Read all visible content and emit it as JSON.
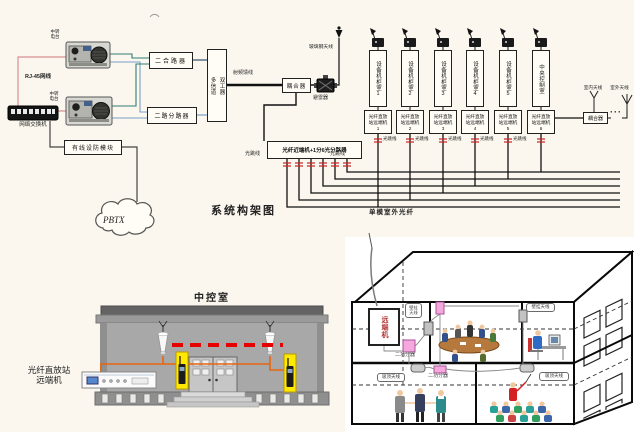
{
  "colors": {
    "page_bg": "#fbf7ee",
    "red_dash": "#e60000",
    "orange_wire": "#e8650f",
    "yellow_holder": "#ffe900",
    "pink_splitter": "#f5a8dc",
    "pink_wire": "#d89090",
    "teal_wire": "#2e7d74",
    "blue_wire": "#7aa0c8",
    "remote_text_red": "#b03030"
  },
  "diagram": {
    "title": "系统构架图",
    "switch_label": "网络交换机",
    "cable_label": "RJ-45网线",
    "radio_top": {
      "l1": "中转",
      "l2": "电台"
    },
    "radio_bottom": {
      "l1": "中转",
      "l2": "电台"
    },
    "combiner": "二合路器",
    "splitter": "二路分路器",
    "duplexer": {
      "l1": "多信道",
      "l2": "双工器"
    },
    "rf_feeder": "射频馈线",
    "coupler": "耦合器",
    "arrester": "避雷器",
    "mast_antenna": "玻璃钢天线",
    "adapter": "有线设防模块",
    "pbx": "PBTX",
    "optical_unit": "光纤近端机+1分6光分路器",
    "jumper": "光跳线",
    "outdoor_fiber": "单模室外光纤",
    "cabinets": [
      {
        "name": "设备机柜室",
        "num": "1"
      },
      {
        "name": "设备机柜室",
        "num": "2"
      },
      {
        "name": "设备机柜室",
        "num": "3"
      },
      {
        "name": "设备机柜室",
        "num": "4"
      },
      {
        "name": "设备机柜室",
        "num": "5"
      },
      {
        "name": "中央控制室",
        "num": ""
      }
    ],
    "remotes": [
      {
        "l1": "光纤直放",
        "l2": "站远端机",
        "num": "1"
      },
      {
        "l1": "光纤直放",
        "l2": "站远端机",
        "num": "2"
      },
      {
        "l1": "光纤直放",
        "l2": "站远端机",
        "num": "3"
      },
      {
        "l1": "光纤直放",
        "l2": "站远端机",
        "num": "4"
      },
      {
        "l1": "光纤直放",
        "l2": "站远端机",
        "num": "5"
      },
      {
        "l1": "光纤直放",
        "l2": "站远端机",
        "num": "6"
      }
    ],
    "coupler2": "耦合器",
    "indoor_antenna": "室内天线",
    "outdoor_antenna": "室外天线",
    "dots": "···"
  },
  "control_room": {
    "title": "中控室",
    "device_l1": "光纤直放站",
    "device_l2": "远端机"
  },
  "building": {
    "remote_unit": "远端机",
    "splitter_a": "二功分器",
    "splitter_b": "二功分器",
    "callout_top": {
      "l1": "壁挂",
      "l2": "天线"
    },
    "callout_right": "壁挂天线",
    "callout_bottom_left": "吸顶天线",
    "callout_bottom_right": "吸顶天线"
  }
}
